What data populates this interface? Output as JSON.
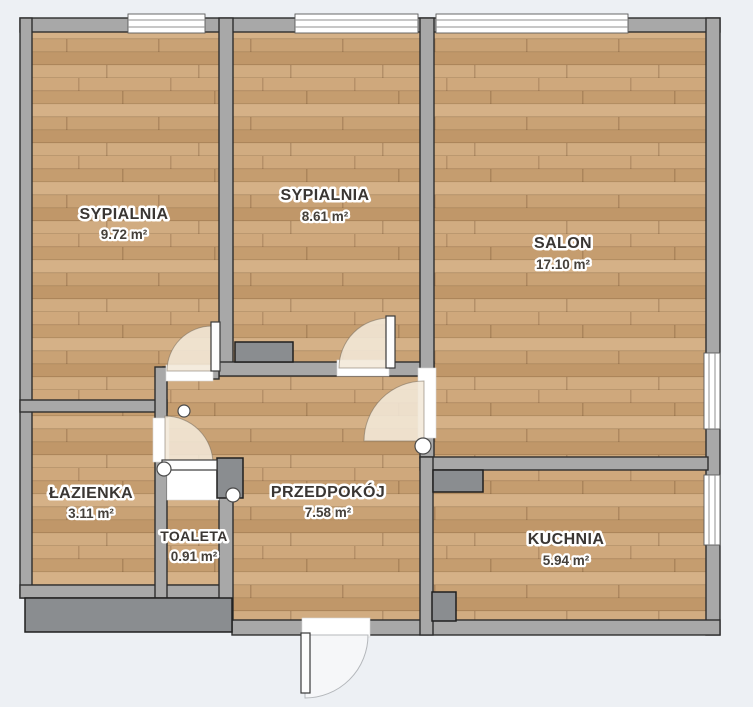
{
  "plan": {
    "colors": {
      "background": "#edf0f4",
      "wall": "#a8a8a8",
      "wall_outline": "#2e2e2e",
      "floor_wood": "#cba379",
      "furniture": "#8a8d90",
      "door_arc": "#f3e8d8"
    },
    "rooms": [
      {
        "id": "sypialnia-1",
        "name": "SYPIALNIA",
        "area": "9.72 m²"
      },
      {
        "id": "sypialnia-2",
        "name": "SYPIALNIA",
        "area": "8.61 m²"
      },
      {
        "id": "salon",
        "name": "SALON",
        "area": "17.10 m²"
      },
      {
        "id": "lazienka",
        "name": "ŁAZIENKA",
        "area": "3.11 m²"
      },
      {
        "id": "toaleta",
        "name": "TOALETA",
        "area": "0.91 m²"
      },
      {
        "id": "przedpokoj",
        "name": "PRZEDPOKÓJ",
        "area": "7.58 m²"
      },
      {
        "id": "kuchnia",
        "name": "KUCHNIA",
        "area": "5.94 m²"
      }
    ]
  }
}
